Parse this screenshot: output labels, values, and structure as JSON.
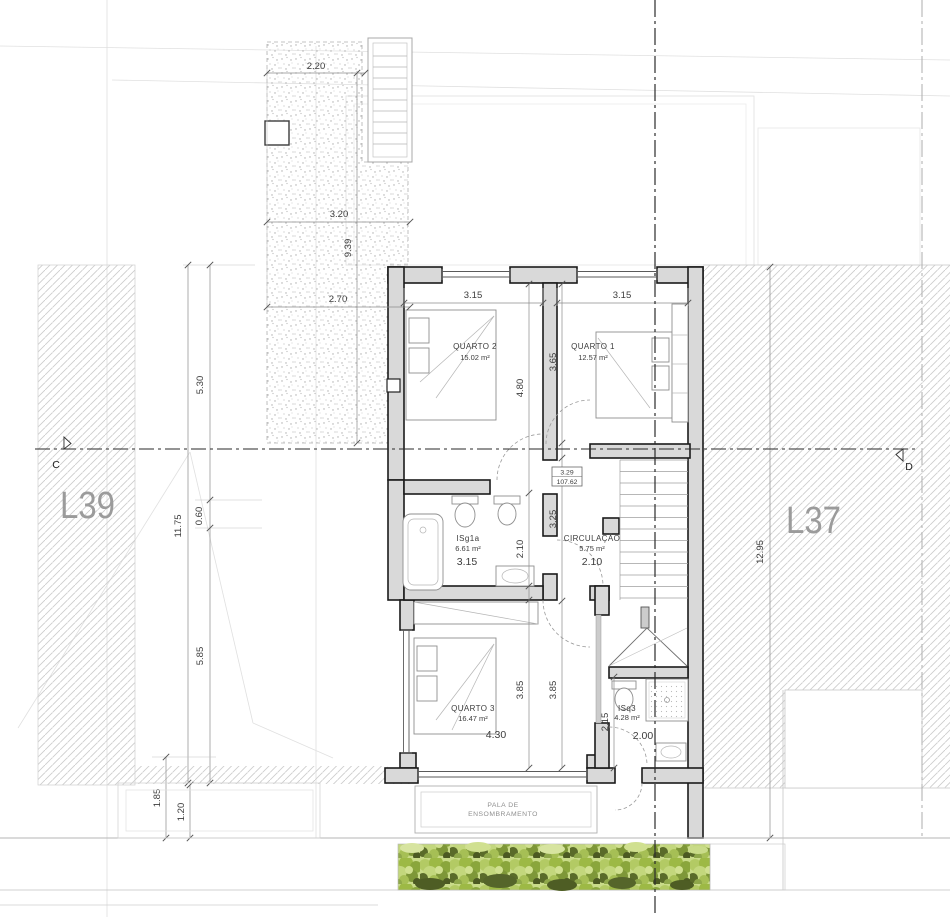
{
  "lots": {
    "left": "L39",
    "right": "L37"
  },
  "section": {
    "left": "C",
    "right": "D"
  },
  "rooms": {
    "quarto2": {
      "name": "QUARTO 2",
      "area": "15.02 m²",
      "width": "3.15",
      "depth": "4.80"
    },
    "quarto1": {
      "name": "QUARTO 1",
      "area": "12.57 m²",
      "width": "3.15",
      "depth": "3.65"
    },
    "isg1a": {
      "name": "ISg1a",
      "area": "6.61 m²",
      "width": "3.15",
      "depth": "2.10"
    },
    "circulacao": {
      "name": "CIRCULAÇÃO",
      "area": "5.75 m²",
      "width": "2.10",
      "depth": "3.25"
    },
    "quarto3": {
      "name": "QUARTO 3",
      "area": "16.47 m²",
      "width": "4.30",
      "depth_a": "3.85",
      "depth_b": "3.85"
    },
    "isq3": {
      "name": "ISq3",
      "area": "4.28 m²",
      "width": "2.00",
      "depth": "2.15"
    }
  },
  "levels": {
    "upper": {
      "height": "3.29",
      "elevation": "107.62"
    },
    "lower": {
      "height": "3.27",
      "elevation": "107.60"
    }
  },
  "canopy": {
    "line1": "PALA DE",
    "line2": "ENSOMBRAMENTO"
  },
  "site_dimensions": {
    "court_top": "2.20",
    "court_mid": "3.20",
    "court_len": "9.39",
    "court_bottom": "2.70",
    "left_upper": "5.30",
    "left_offset": "0.60",
    "left_total": "11.75",
    "left_lower": "5.85",
    "canopy_a": "1.85",
    "canopy_b": "1.20",
    "right_total": "12.95"
  },
  "colors": {
    "wall_fill": "#d9d9d9",
    "hatch": "#cdcdcd",
    "vegetation": "#9db945",
    "lot_label": "#9b9b9b"
  }
}
